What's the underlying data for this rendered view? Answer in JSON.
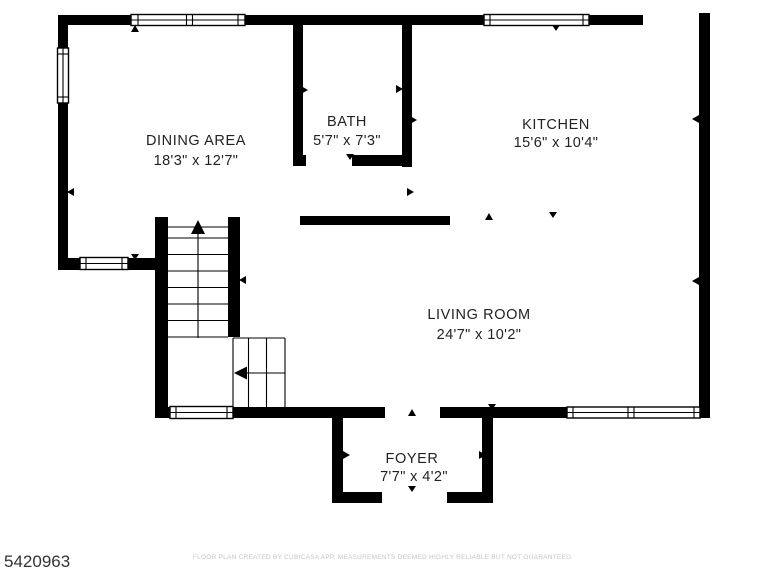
{
  "plan": {
    "id": "5420963",
    "disclaimer": "FLOOR PLAN CREATED BY CUBICASA APP. MEASUREMENTS DEEMED HIGHLY RELIABLE BUT NOT GUARANTEED.",
    "rooms": {
      "dining": {
        "name": "DINING AREA",
        "dims": "18'3\" x 12'7\""
      },
      "bath": {
        "name": "BATH",
        "dims": "5'7\" x 7'3\""
      },
      "kitchen": {
        "name": "KITCHEN",
        "dims": "15'6\" x 10'4\""
      },
      "living": {
        "name": "LIVING ROOM",
        "dims": "24'7\" x 10'2\""
      },
      "foyer": {
        "name": "FOYER",
        "dims": "7'7\" x 4'2\""
      }
    },
    "colors": {
      "wall": "#000000",
      "background": "#ffffff",
      "room_text": "#222222",
      "id_text": "#333333",
      "disclaimer_text": "#c5c5c5"
    }
  }
}
